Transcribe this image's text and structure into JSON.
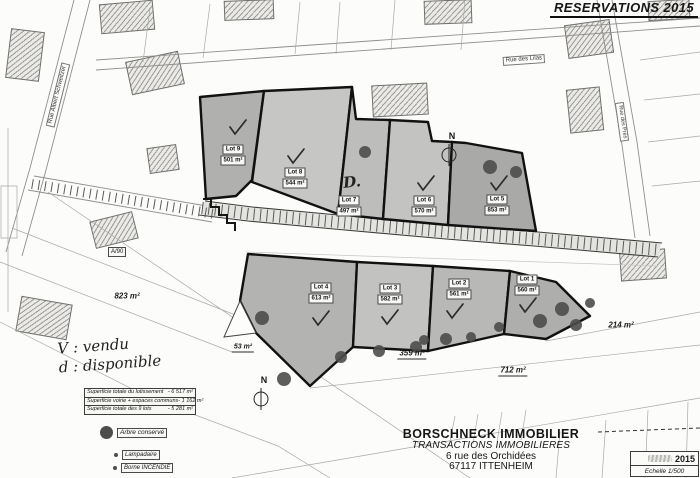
{
  "header": {
    "title": "RESERVATIONS 2015"
  },
  "streets": {
    "west": "Rue Albert Schweitzer",
    "north": "Rue des Lilas",
    "east": "Rue des Prés"
  },
  "lots": [
    {
      "name": "Lot 1",
      "area": "560 m²",
      "status": "vendu"
    },
    {
      "name": "Lot 2",
      "area": "561 m²",
      "status": "vendu"
    },
    {
      "name": "Lot 3",
      "area": "582 m²",
      "status": "vendu"
    },
    {
      "name": "Lot 4",
      "area": "613 m²",
      "status": "vendu"
    },
    {
      "name": "Lot 5",
      "area": "853 m²",
      "status": "vendu"
    },
    {
      "name": "Lot 6",
      "area": "570 m²",
      "status": "vendu"
    },
    {
      "name": "Lot 7",
      "area": "497 m²",
      "status": "disponible"
    },
    {
      "name": "Lot 8",
      "area": "544 m²",
      "status": "vendu"
    },
    {
      "name": "Lot 9",
      "area": "501 m²",
      "status": "vendu"
    }
  ],
  "parcel_areas": {
    "left": "823 m²",
    "triangle": "53 m²",
    "south_mid": "359 m²",
    "south": "712 m²",
    "east": "214 m²",
    "road_ref": "A/90"
  },
  "handwriting": {
    "legend_line1": "V : vendu",
    "legend_line2": "d : disponible",
    "lot7_mark": "D."
  },
  "summary_table": {
    "rows": [
      {
        "label": "Superficie totale du lotissement",
        "value": "- 6 517 m²"
      },
      {
        "label": "Superficie voirie + espaces communs",
        "value": "- 1 162 m²"
      },
      {
        "label": "Superficie totale des 9 lots",
        "value": "- 5 281 m²"
      }
    ]
  },
  "legend": {
    "tree": "Arbre conservé",
    "lamp": "Lampadaire",
    "hydrant": "Borne INCENDIE"
  },
  "firm": {
    "name": "BORSCHNECK IMMOBILIER",
    "subtitle": "TRANSACTIONS IMMOBILIERES",
    "address_line1": "6 rue des Orchidées",
    "address_line2": "67117 ITTENHEIM"
  },
  "scale_box": {
    "year": "2015",
    "scale": "Echelle 1/500"
  },
  "compass": {
    "label": "N"
  },
  "colors": {
    "outline": "#111111",
    "tree": "#4d4d4b",
    "lot_fill": "#bcbcbc"
  }
}
